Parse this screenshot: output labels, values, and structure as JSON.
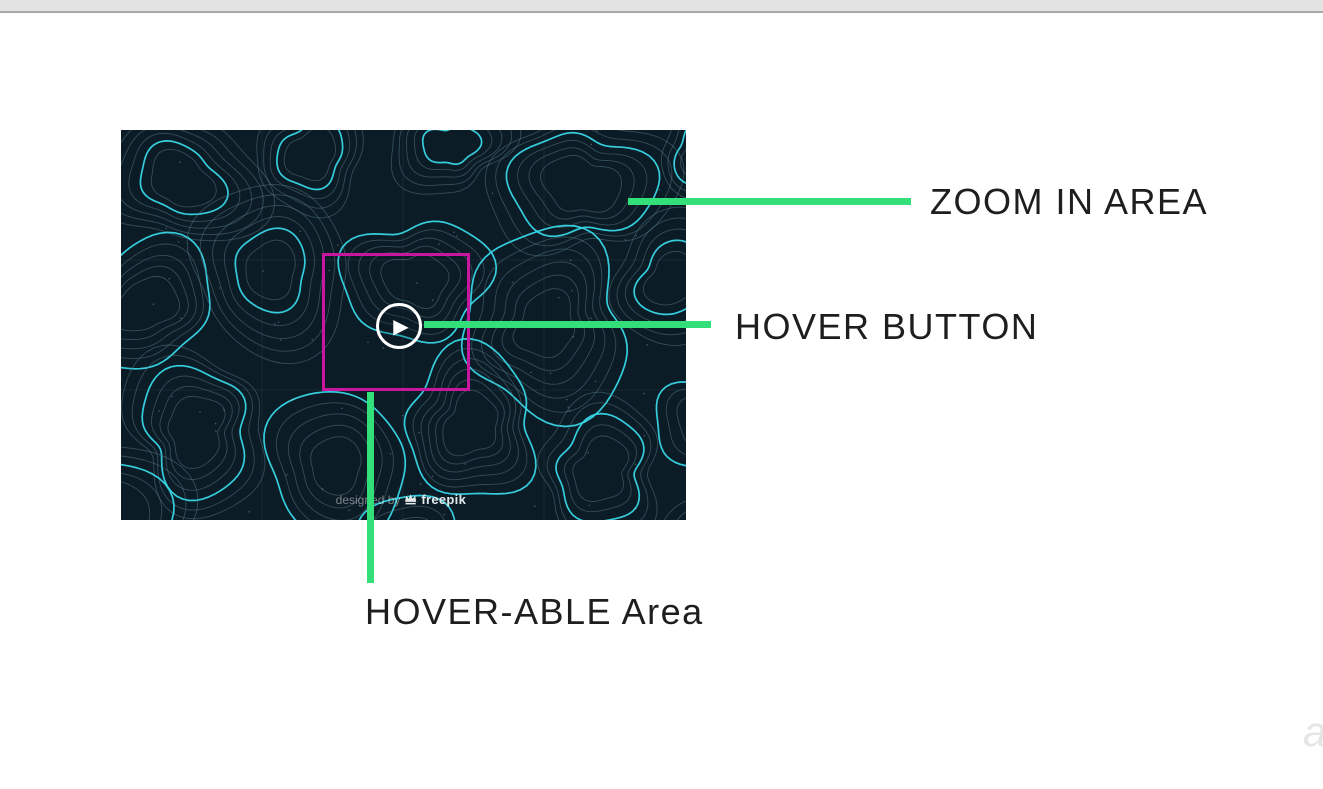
{
  "page": {
    "background": "#ffffff",
    "topbar_color": "#e3e3e3"
  },
  "annotations": {
    "zoom_area_label": "ZOOM IN AREA",
    "hover_button_label": "HOVER BUTTON",
    "hoverable_area_label": "HOVER-ABLE Area",
    "accent_green": "#32df79",
    "accent_magenta": "#c9169e",
    "label_color": "#1e1e1e"
  },
  "demo_image": {
    "watermark_prefix": "designed by",
    "watermark_brand": "freepik",
    "background": "#0c1c26",
    "contour_bright": "#38d6e6",
    "contour_dim": "#5a7d8a"
  },
  "player": {
    "play_icon": "▶"
  }
}
